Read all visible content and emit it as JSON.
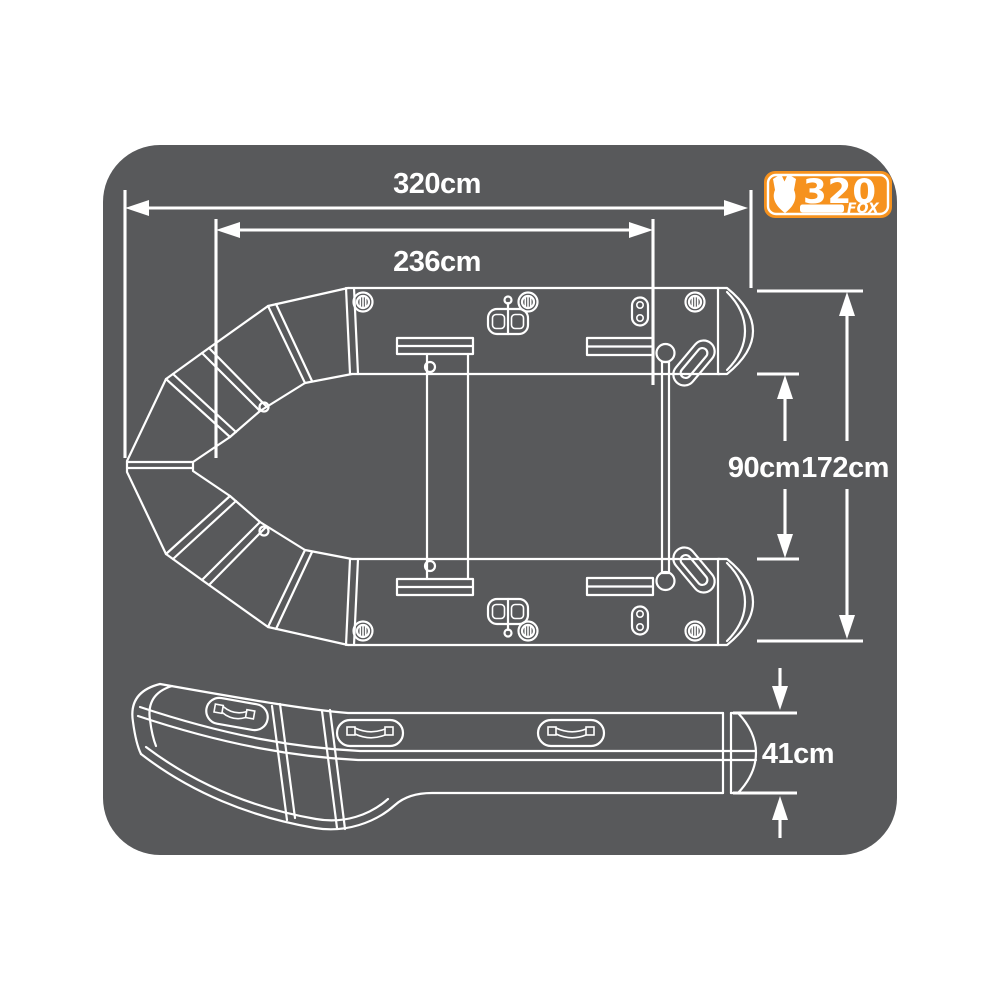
{
  "colors": {
    "page_bg": "#ffffff",
    "panel_bg": "#58595b",
    "line": "#ffffff",
    "badge_orange": "#f6921e"
  },
  "badge": {
    "model": "320",
    "brand": "FOX",
    "icon": "fox-head-icon"
  },
  "dimensions": {
    "overall_length": "320cm",
    "internal_length": "236cm",
    "internal_width": "90cm",
    "overall_width": "172cm",
    "tube_height": "41cm"
  }
}
